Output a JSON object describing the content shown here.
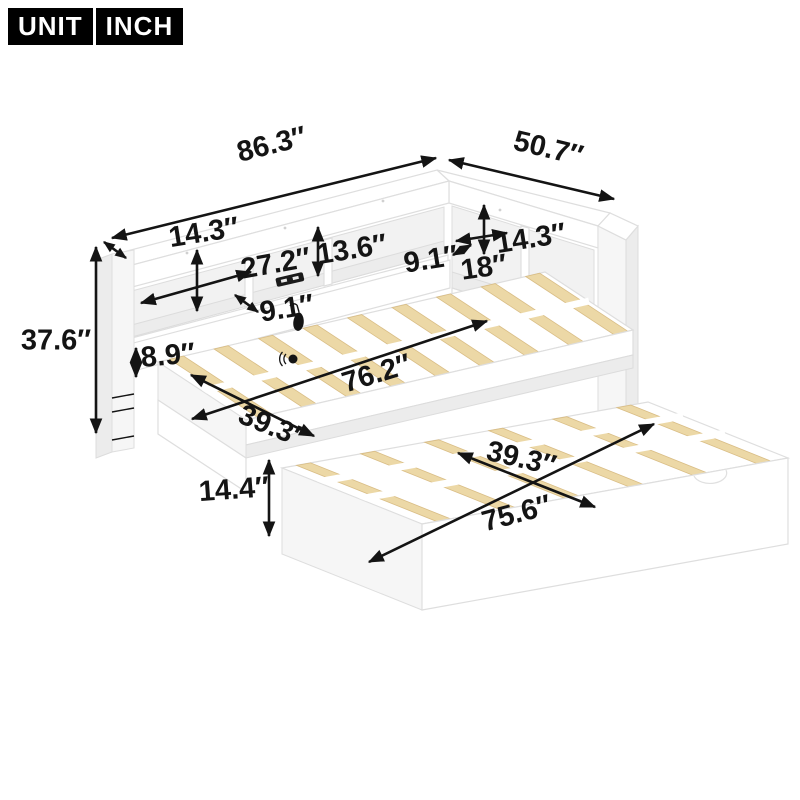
{
  "badge": {
    "unit": "UNIT",
    "inch": "INCH"
  },
  "dims": {
    "overall_length": "86.3″",
    "overall_depth": "50.7″",
    "left_shelf_height": "14.3″",
    "left_cubby_width": "27.2″",
    "cubby_height": "13.6″",
    "left_shelf_depth": "9.1″",
    "right_shelf_depth": "9.1″",
    "right_bookcase_height": "18″",
    "right_cubby_width": "14.3″",
    "overall_height": "37.6″",
    "side_rail_height": "8.9″",
    "sleep_length": "76.2″",
    "sleep_width": "39.3″",
    "trundle_height": "14.4″",
    "trundle_width": "39.3″",
    "trundle_length": "75.6″"
  },
  "icons": {
    "usb_outlet": "usb-outlet-icon",
    "hanging_hook": "hanging-hook-icon",
    "wall_knob": "wall-knob-icon"
  },
  "colors": {
    "arrow": "#141414",
    "slat": "#ecd8a6",
    "slat_edge": "#d9bd85",
    "frame_line": "#dedede",
    "badge_bg": "#000000",
    "badge_text": "#ffffff"
  }
}
